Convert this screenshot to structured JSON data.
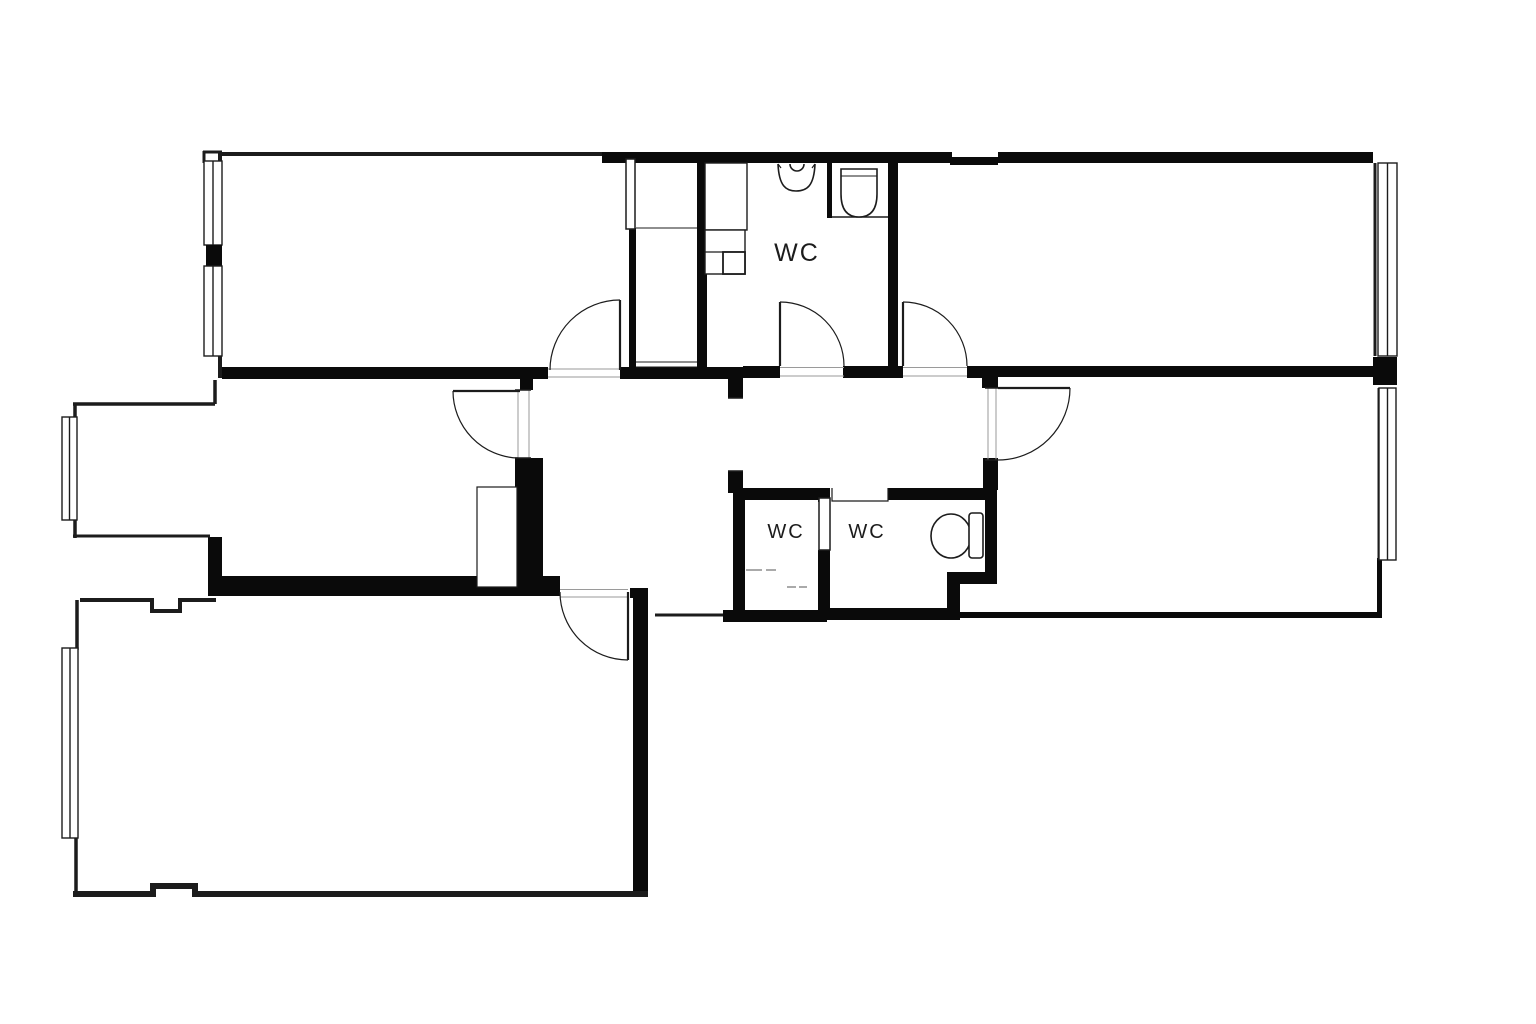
{
  "page": {
    "background_color": "#ffffff",
    "wall_color": "#0a0a0a",
    "thin_line_color": "#1c1c1c",
    "opening_line_color": "#9a9a9a",
    "text_color": "#1c1c1c"
  },
  "labels": {
    "wc_top": "WC",
    "wc_bottom_left": "WC",
    "wc_bottom_right": "WC"
  }
}
